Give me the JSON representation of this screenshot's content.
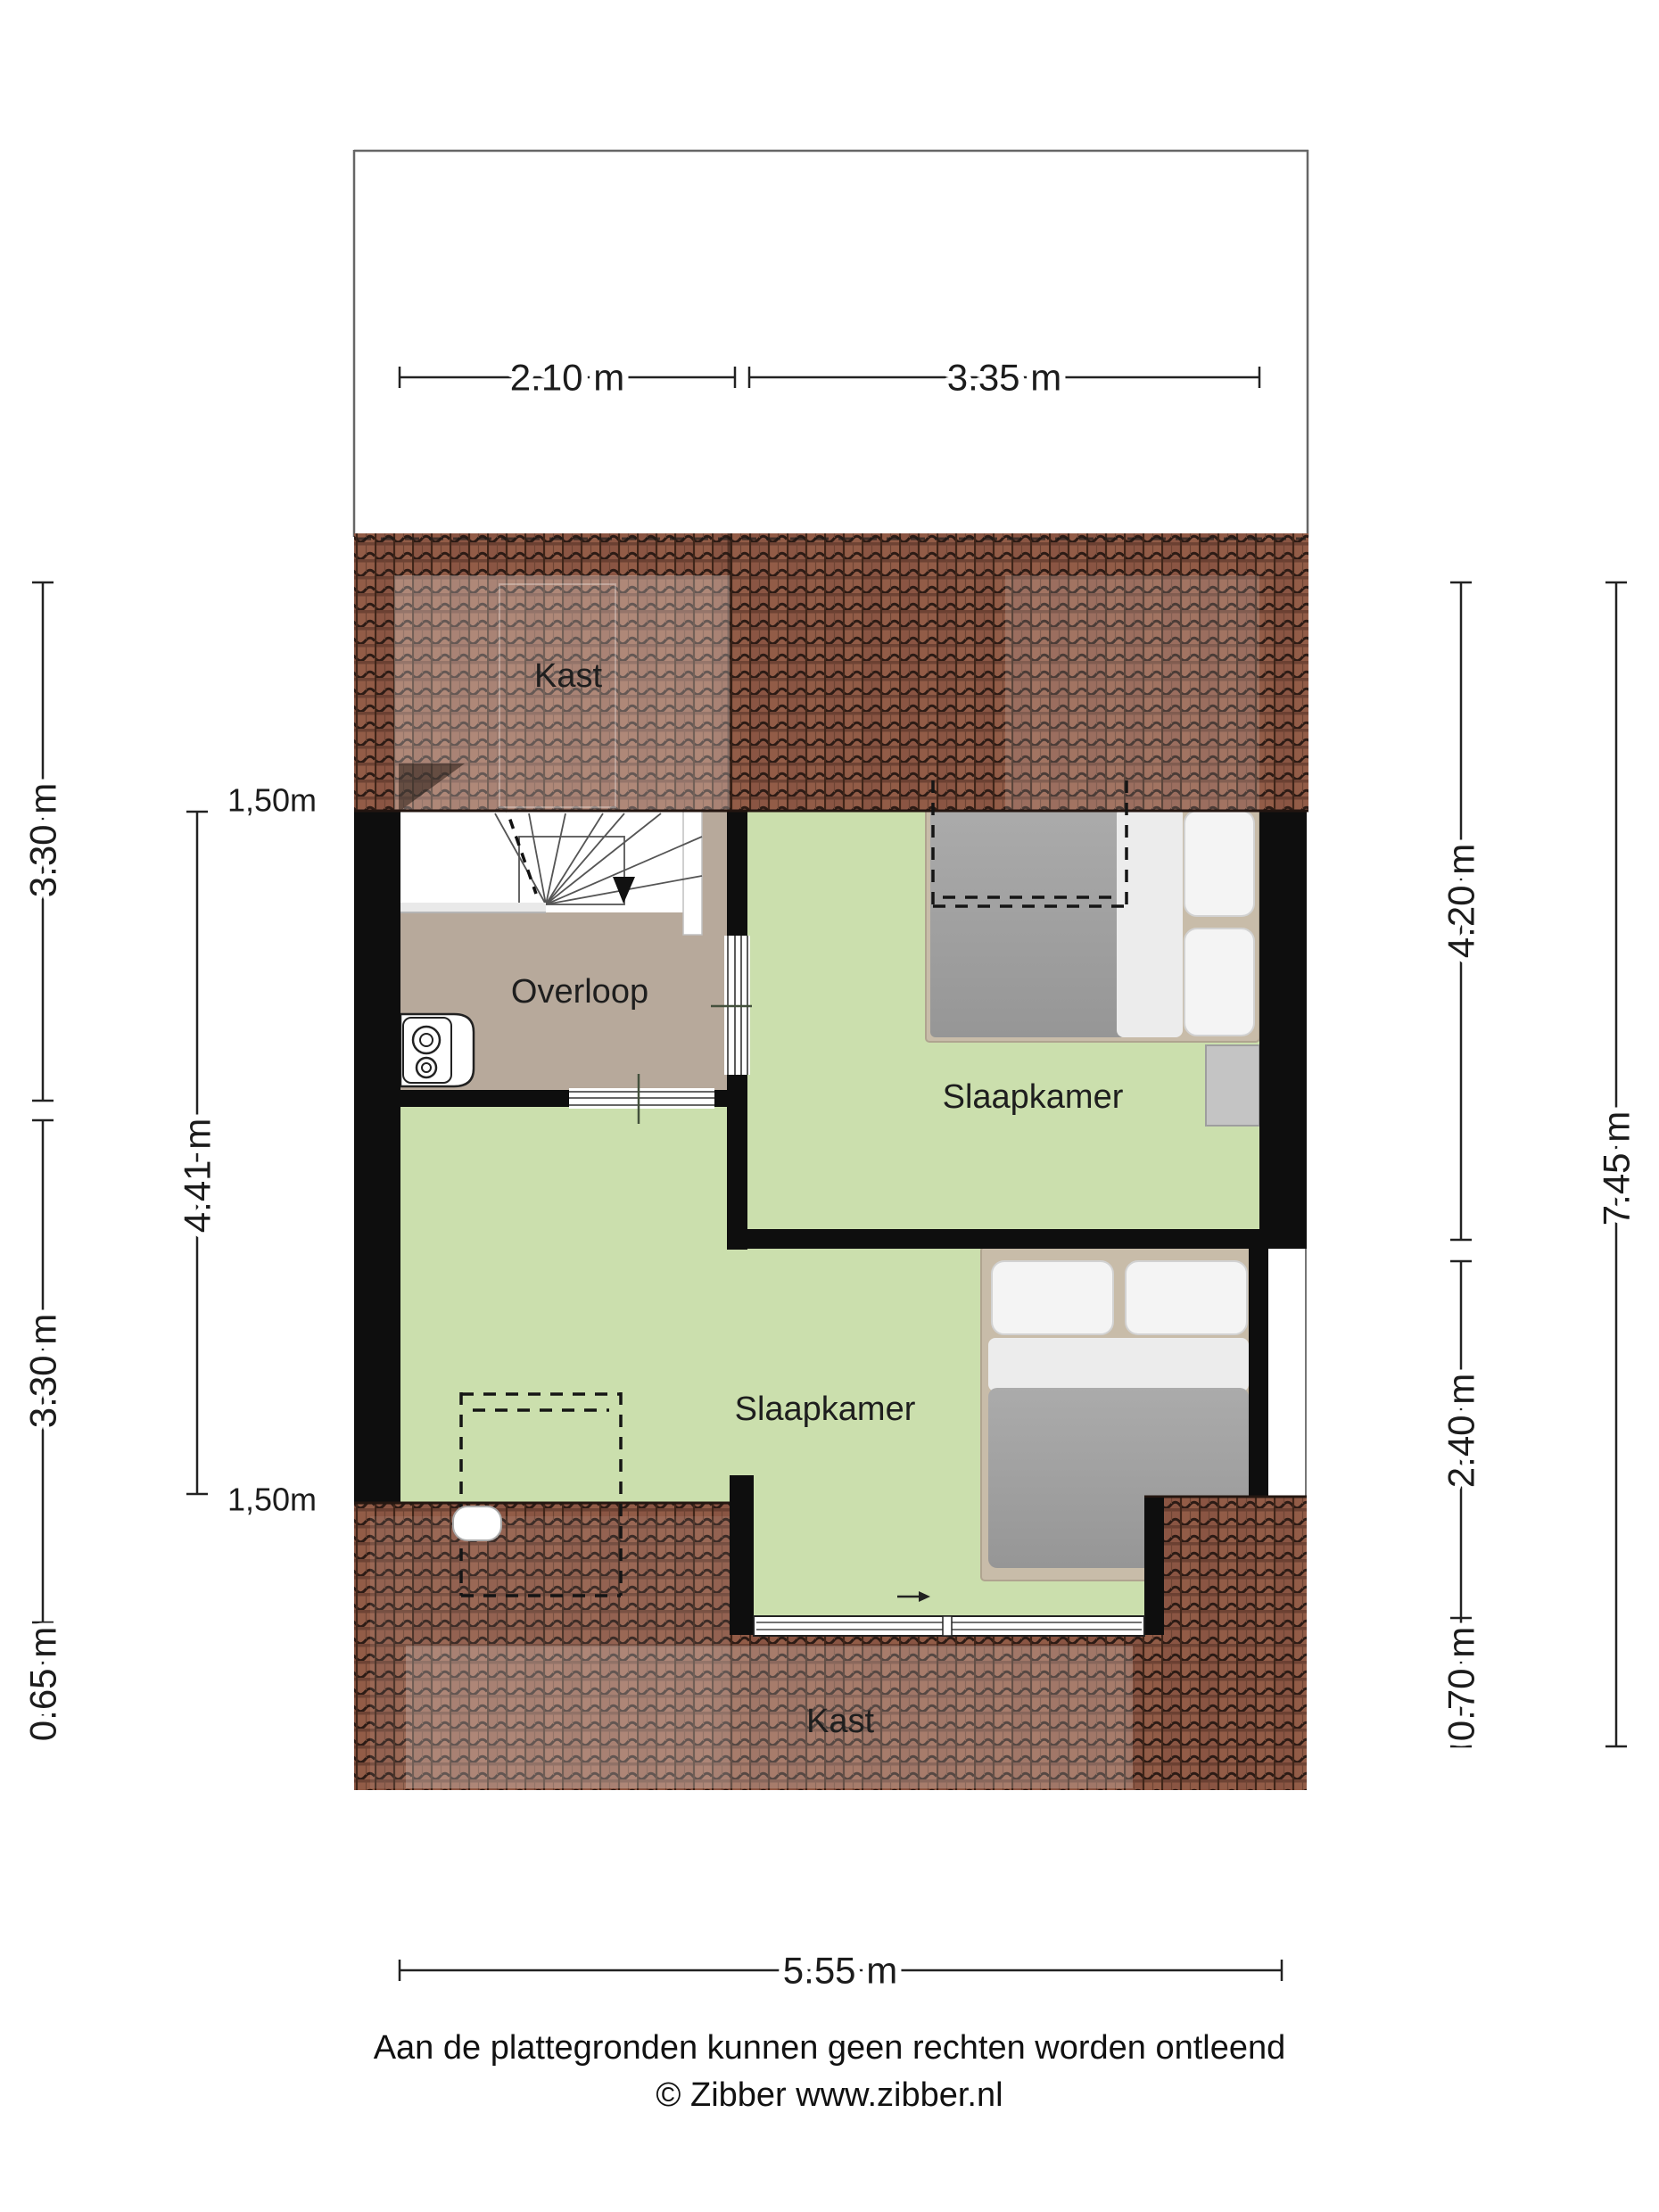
{
  "title": "Floor plan - attic storey (verdieping met slaapkamers)",
  "rooms": {
    "kast_top": "Kast",
    "overloop": "Overloop",
    "slaapkamer_right": "Slaapkamer",
    "slaapkamer_bottom": "Slaapkamer",
    "kast_bottom": "Kast"
  },
  "dimensions": {
    "top_left": "2.10 m",
    "top_right": "3.35 m",
    "bottom": "5.55 m",
    "left_upper": "3.30 m",
    "left_lower": "3.30 m",
    "left_bottom": "0.65 m",
    "left_inner": "4.41 m",
    "knee_upper": "1,50m",
    "knee_lower": "1,50m",
    "right_upper": "4.20 m",
    "right_total": "7.45 m",
    "right_lower": "2.40 m",
    "right_bottom": "0.70 m"
  },
  "footer": {
    "disclaimer": "Aan de plattegronden kunnen geen rechten worden ontleend",
    "copyright": "© Zibber www.zibber.nl"
  },
  "colors": {
    "floor_green": "#cbdfad",
    "floor_taupe": "#b7a99b",
    "wall_black": "#0e0e0e",
    "roof_tile_base": "#8a5543",
    "roof_tile_line": "#2c1b15",
    "bed_duvet_gray": "#9f9f9f",
    "bed_linen_white": "#f2f2f2",
    "bed_frame_beige": "#c8bca9",
    "dimension_ink": "#1c1c1c",
    "plan_border_gray": "#666666"
  }
}
